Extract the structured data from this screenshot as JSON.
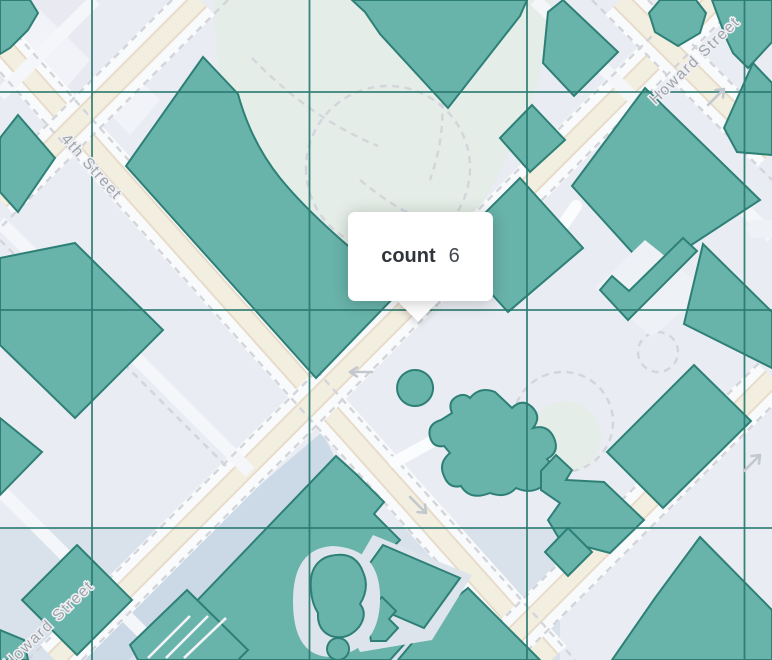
{
  "map": {
    "width": 772,
    "height": 660,
    "tooltip": {
      "label": "count",
      "value": "6",
      "x": 348,
      "y": 212,
      "w": 145,
      "h": 89,
      "caret_cx": 418,
      "caret_cy": 302
    },
    "street_labels": [
      {
        "id": "street-label-4th-street",
        "text": "4th Street",
        "x": 88,
        "y": 170,
        "rotate": 48
      },
      {
        "id": "street-label-howard-street-top",
        "text": "Howard Street",
        "x": 698,
        "y": 64,
        "rotate": -44
      },
      {
        "id": "street-label-howard-street-bottom",
        "text": "Howard Street",
        "x": 52,
        "y": 628,
        "rotate": -44
      }
    ],
    "palette": {
      "bg": "#e9ecf2",
      "cellBlue": "#d6e0ea",
      "cellLavender": "#e9eaf1",
      "band": "#c9d7e5",
      "park": "#e4ede7",
      "building": "#f2f4f8",
      "road": "#f3efe0",
      "roadEdge": "#e7dbc9",
      "casing": "#f9fafc",
      "alley": "#f4f6f9",
      "dash": "#d3d5db",
      "teal": "#68b3aa",
      "tealStroke": "#2e8077",
      "grid": "#2b7a70",
      "halo": "#dde4ec",
      "paper": "#eef1f5",
      "hatch": "#f2f4f8",
      "arrow": "#c3c8cf",
      "pill": "#fbfcfe"
    },
    "grid": {
      "vertical_x": [
        92,
        309.5,
        527,
        744.5
      ],
      "horizontal_y": [
        92,
        310,
        528
      ]
    },
    "tints": [
      {
        "name": "cell-tint-top-left",
        "d": "M0,0 L92,0 L92,92 L0,92 Z",
        "fill": "cellLavender",
        "opacity": 0.55
      },
      {
        "name": "cell-tint-bottom-blue",
        "d": "M0,528 L560,528 L560,660 L0,660 Z",
        "fill": "cellBlue",
        "opacity": 0.85
      },
      {
        "name": "park-area",
        "d": "M213,0 L553,0 Q546,80 515,140 Q480,215 437,280 Q415,315 385,332 L350,330 Q300,300 268,255 Q240,210 228,150 Q218,80 213,0 Z",
        "fill": "park",
        "opacity": 1
      },
      {
        "name": "park-circle-lawn",
        "d": "M565,401 a36,36 0 1,0 0.1,0 Z",
        "fill": "park",
        "opacity": 1
      },
      {
        "name": "howard-side-band",
        "d": "M55,660 L128,660 L345,478 L322,432 Z",
        "fill": "band",
        "opacity": 0.9
      },
      {
        "name": "building-footprint-1",
        "d": "M40,10 L90,60 L60,95 L10,45 Z",
        "fill": "building",
        "opacity": 0.9
      },
      {
        "name": "building-footprint-2",
        "d": "M120,60 L160,100 L130,135 L95,98 Z",
        "fill": "building",
        "opacity": 0.9
      }
    ],
    "roads": [
      {
        "name": "road-4th-street",
        "x1": 0,
        "y1": 43,
        "x2": 551,
        "y2": 660,
        "kind": "major"
      },
      {
        "name": "road-cross-nw",
        "x1": 200,
        "y1": 0,
        "x2": 0,
        "y2": 200,
        "kind": "major"
      },
      {
        "name": "road-howard",
        "x1": 55,
        "y1": 660,
        "x2": 715,
        "y2": 0,
        "kind": "major"
      },
      {
        "name": "road-cross-ne",
        "x1": 620,
        "y1": 0,
        "x2": 772,
        "y2": 152,
        "kind": "major"
      },
      {
        "name": "road-cross-se",
        "x1": 490,
        "y1": 660,
        "x2": 772,
        "y2": 378,
        "kind": "major"
      },
      {
        "name": "alley-corner-tl",
        "x1": 95,
        "y1": 0,
        "x2": 0,
        "y2": 95,
        "kind": "alley"
      },
      {
        "name": "alley-left-mid",
        "x1": 0,
        "y1": 222,
        "x2": 250,
        "y2": 472,
        "kind": "alley"
      },
      {
        "name": "alley-left-low",
        "x1": 0,
        "y1": 490,
        "x2": 170,
        "y2": 660,
        "kind": "alley"
      },
      {
        "name": "alley-top-center",
        "x1": 535,
        "y1": 0,
        "x2": 662,
        "y2": 127,
        "kind": "alley"
      },
      {
        "name": "alley-tr-stub",
        "x1": 745,
        "y1": 210,
        "x2": 772,
        "y2": 237,
        "kind": "alley"
      }
    ],
    "dashes": [
      {
        "name": "dash-4th-a",
        "d": "M0,16 L575,660"
      },
      {
        "name": "dash-4th-b",
        "d": "M0,72 L525,660"
      },
      {
        "name": "dash-howard-a",
        "d": "M28,660 L688,0"
      },
      {
        "name": "dash-howard-b",
        "d": "M82,660 L742,0"
      },
      {
        "name": "dash-nw-a",
        "d": "M172,0 L0,172"
      },
      {
        "name": "dash-nw-b",
        "d": "M228,0 L0,228"
      },
      {
        "name": "dash-ne-a",
        "d": "M648,0 L772,124"
      },
      {
        "name": "dash-ne-b",
        "d": "M592,0 L772,180"
      },
      {
        "name": "dash-se-a",
        "d": "M462,660 L772,350"
      },
      {
        "name": "dash-se-b",
        "d": "M518,660 L772,406"
      },
      {
        "name": "dash-alley",
        "d": "M0,240 L230,470"
      },
      {
        "name": "dash-park-arc",
        "d": "M306,168 a82,82 0 1,0 164,0 a82,82 0 1,0 -164,0"
      },
      {
        "name": "dash-park-q1",
        "d": "M252,58 Q310,118 378,146"
      },
      {
        "name": "dash-park-q2",
        "d": "M430,40 Q455,110 430,180"
      },
      {
        "name": "dash-park-q3",
        "d": "M360,180 Q420,230 470,230"
      },
      {
        "name": "dash-circle-1",
        "d": "M513,422 a50,50 0 1,0 100,0 a50,50 0 1,0 -100,0"
      },
      {
        "name": "dash-circle-2",
        "d": "M638,352 a20,20 0 1,0 40,0 a20,20 0 1,0 -40,0"
      }
    ],
    "pills": [
      {
        "name": "path-pill-1",
        "d": "M557,234 L576,206"
      },
      {
        "name": "path-pill-2",
        "d": "M395,462 L433,441"
      }
    ],
    "shapes": [
      {
        "name": "block-corner-tl",
        "d": "M0,0 L30,0 L38,13 L28,30 L10,48 L0,54 Z",
        "fill": "teal"
      },
      {
        "name": "block-left-upper",
        "d": "M18,115 L55,158 L18,212 L0,192 L0,138 Z",
        "fill": "teal"
      },
      {
        "name": "block-left-big",
        "d": "M75,243 L163,330 L75,418 L0,345 L0,258 Z",
        "fill": "teal"
      },
      {
        "name": "block-left-low",
        "d": "M0,418 L42,452 L0,495 Z",
        "fill": "teal"
      },
      {
        "name": "block-central-big",
        "d": "M203,57 L126,166 L316,378 L402,289 C360,258 310,215 280,178 C256,148 244,116 238,94 Z",
        "fill": "teal"
      },
      {
        "name": "block-top-big",
        "d": "M352,0 L527,0 L520,16 L448,108 L380,34 L365,12 Z",
        "fill": "teal"
      },
      {
        "name": "block-top-mid",
        "d": "M563,0 L618,52 L574,96 L543,63 L548,12 Z",
        "fill": "teal"
      },
      {
        "name": "block-top-octagon",
        "d": "M660,0 L696,0 L706,13 L700,33 L678,46 L655,32 L649,13 Z",
        "fill": "teal"
      },
      {
        "name": "block-tr-corner",
        "d": "M712,0 L772,0 L772,42 L748,68 L733,53 L726,38 Z",
        "fill": "teal"
      },
      {
        "name": "block-tr-d2",
        "d": "M753,63 L772,83 L772,155 L737,152 L724,128 Z",
        "fill": "teal"
      },
      {
        "name": "block-right-big",
        "d": "M645,88 L760,200 L650,272 L572,186 Z",
        "fill": "teal"
      },
      {
        "name": "check-background",
        "d": "M645,240 L707,290 L652,337 L595,288 Z",
        "fill": "paper"
      },
      {
        "name": "check-band",
        "d": "M600,290 L628,320 L697,251 L683,238 L629,291 L612,276 Z",
        "fill": "teal"
      },
      {
        "name": "block-right-strip",
        "d": "M703,244 L772,312 L772,368 L684,324 Z",
        "fill": "teal"
      },
      {
        "name": "block-mid-right",
        "d": "M520,178 L583,248 L508,312 L450,248 Z",
        "fill": "teal"
      },
      {
        "name": "block-mid-small",
        "d": "M532,105 L565,140 L530,172 L500,138 Z",
        "fill": "teal"
      },
      {
        "name": "round-building",
        "d": "M415,370 a18,18 0 1,0 0.1,0 Z",
        "fill": "teal"
      },
      {
        "name": "organic-blob",
        "d": "M470,398 Q480,386 495,392 L512,408 Q522,398 532,407 Q542,417 533,428 Q548,424 554,438 Q560,452 547,459 Q557,470 547,482 Q534,496 516,488 Q506,499 490,493 Q470,501 461,486 Q449,489 444,476 Q438,463 450,453 L444,446 Q433,448 430,437 Q427,424 441,420 L452,413 Q447,401 458,396 Q465,393 470,398 Z",
        "fill": "teal"
      },
      {
        "name": "block-rect-se",
        "d": "M694,365 L751,421 L663,508 L607,452 Z",
        "fill": "teal"
      },
      {
        "name": "block-house-se",
        "d": "M541,471 L556,455 L572,470 L566,480 L604,482 L644,520 L610,553 L560,540 L548,520 L560,503 L541,490 Z",
        "fill": "teal"
      },
      {
        "name": "block-small-se",
        "d": "M568,528 L592,552 L568,576 L545,552 Z",
        "fill": "teal"
      },
      {
        "name": "block-corner-br",
        "d": "M700,537 L772,610 L772,660 L612,660 L655,598 Z",
        "fill": "teal"
      },
      {
        "name": "block-bottom-right",
        "d": "M468,588 L540,660 L398,660 L438,612 Z",
        "fill": "teal"
      },
      {
        "name": "block-bottom-mass",
        "d": "M140,660 L336,456 L356,474 L384,502 L374,514 L400,540 L390,550 L417,576 L404,590 L416,606 L398,628 L407,641 L390,660 Z",
        "fill": "teal"
      },
      {
        "name": "block-bl-diamond1",
        "d": "M77,545 L132,600 L77,655 L22,600 Z",
        "fill": "teal"
      },
      {
        "name": "block-bl-diamond2",
        "d": "M187,590 L248,650 L238,660 L138,660 L130,645 Z",
        "fill": "teal"
      },
      {
        "name": "block-bl-corner",
        "d": "M0,630 L24,640 L28,660 L0,660 Z",
        "fill": "teal"
      },
      {
        "name": "halo-parallelogram",
        "d": "M373,535 L472,575 L432,640 L360,652 L335,600 Z",
        "fill": "halo"
      },
      {
        "name": "block-parallelogram",
        "d": "M383,545 L460,578 L424,628 L347,595 Z",
        "fill": "teal"
      },
      {
        "name": "block-cross-bldg",
        "d": "M367,612 L382,597 L396,611 L389,619 L398,628 L386,641 L371,641 L369,629 Z",
        "fill": "teal"
      },
      {
        "name": "halo-blob-bottom",
        "d": "M332,546 Q382,548 380,602 Q378,652 330,657 Q293,656 293,601 Q293,549 332,546 Z",
        "fill": "halo"
      },
      {
        "name": "blob-bottom",
        "d": "M330,556 Q355,550 363,572 Q370,588 360,604 Q368,614 359,627 Q347,641 331,636 Q317,630 318,613 Q312,604 311,590 Q309,570 320,561 Q325,557 330,556 Z",
        "fill": "teal"
      },
      {
        "name": "blob-bottom-circle",
        "d": "M338,638 a11,11 0 1,0 0.1,0 Z",
        "fill": "teal"
      },
      {
        "name": "white-notch",
        "d": "M772,220 L752,220 L745,229 L752,238 L772,238 Z",
        "fill": "paper"
      }
    ],
    "hatch_lines": [
      {
        "name": "hatch-1",
        "d": "M148,658 L190,616"
      },
      {
        "name": "hatch-2",
        "d": "M166,658 L208,616"
      },
      {
        "name": "hatch-3",
        "d": "M184,658 L226,618"
      }
    ],
    "arrows": [
      {
        "name": "oneway-arrow-left",
        "d": "M372,372 L350,372 M357,367.5 L350,372 L357,376.5"
      },
      {
        "name": "oneway-arrow-ne",
        "d": "M708,105 L724,89 M715.5,90 L724,89 L723,97.5"
      },
      {
        "name": "oneway-arrow-se",
        "d": "M410,497 L426,513 M417.5,512 L426,513 L425,504.5"
      },
      {
        "name": "oneway-arrow-se2",
        "d": "M744,471 L760,455 M751.5,456 L760,455 L759,463.5"
      }
    ]
  }
}
